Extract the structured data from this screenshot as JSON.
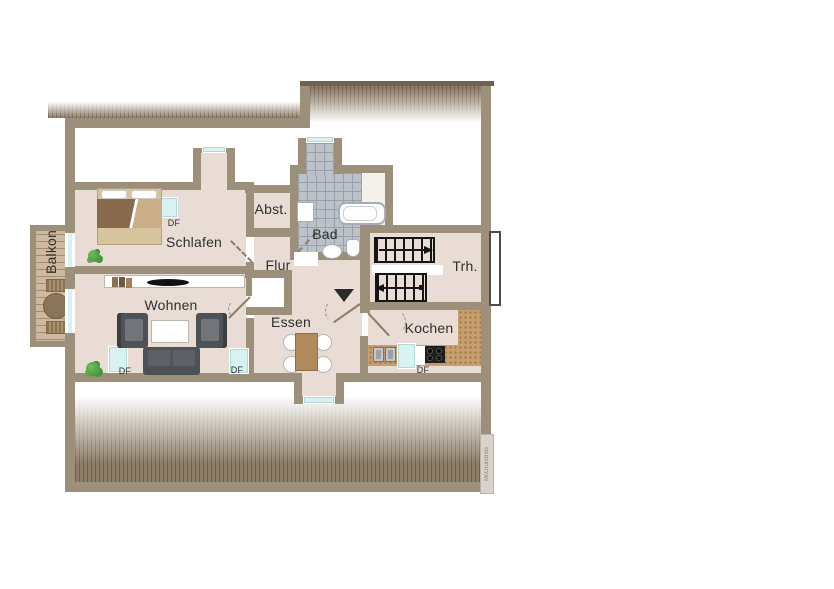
{
  "rooms": {
    "balkon": {
      "label": "Balkon"
    },
    "schlafen": {
      "label": "Schlafen"
    },
    "wohnen": {
      "label": "Wohnen"
    },
    "flur": {
      "label": "Flur"
    },
    "abst": {
      "label": "Abst."
    },
    "bad": {
      "label": "Bad"
    },
    "trh": {
      "label": "Trh."
    },
    "essen": {
      "label": "Essen"
    },
    "kochen": {
      "label": "Kochen"
    }
  },
  "skylights": {
    "schlafen": "DF",
    "wohnen_left": "DF",
    "wohnen_right": "DF",
    "kochen": "DF"
  },
  "watermark": "McGrundriss",
  "colors": {
    "wall": "#9d907b",
    "wall-dark": "#6e6253",
    "floor": "#e9dcd4",
    "tile": "#bcc2c9",
    "tile-line": "#98a0aa",
    "window": "#d8f2f1",
    "cork": "#c79e6e",
    "wood": "#cdb9a0",
    "roof": "#8d7c66",
    "furniture": "#4e5155",
    "table-wood": "#b08a5a",
    "plant": "#3f8a38",
    "ink": "#1c1c1c"
  }
}
